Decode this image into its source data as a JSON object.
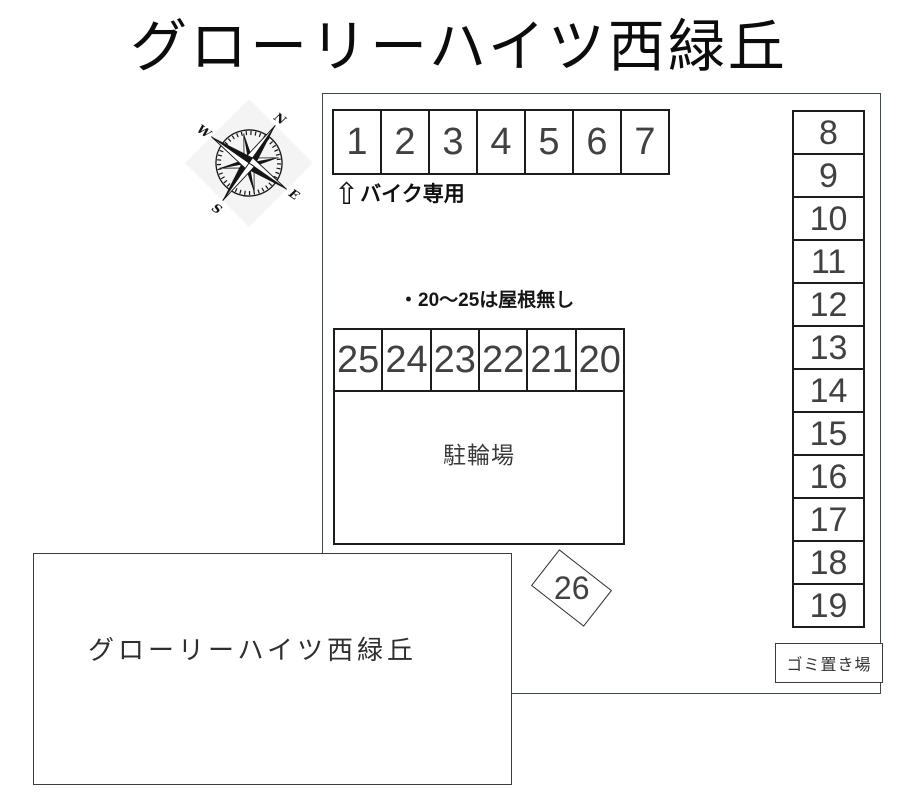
{
  "page": {
    "title": "グローリーハイツ西緑丘"
  },
  "compass": {
    "north_label": "N",
    "east_label": "E",
    "south_label": "S",
    "west_label": "W",
    "rotation_deg": 35
  },
  "bike_row": {
    "spaces": [
      "1",
      "2",
      "3",
      "4",
      "5",
      "6",
      "7"
    ],
    "arrow": "⇧",
    "caption": "バイク専用"
  },
  "note": {
    "text": "・20〜25は屋根無し"
  },
  "uncovered_row": {
    "spaces": [
      "25",
      "24",
      "23",
      "22",
      "21",
      "20"
    ]
  },
  "right_column": {
    "spaces": [
      "8",
      "9",
      "10",
      "11",
      "12",
      "13",
      "14",
      "15",
      "16",
      "17",
      "18",
      "19"
    ]
  },
  "bicycle_area": {
    "label": "駐輪場"
  },
  "diagonal_space": {
    "label": "26"
  },
  "garbage_area": {
    "label": "ゴミ置き場"
  },
  "building": {
    "label": "グローリーハイツ西緑丘"
  },
  "colors": {
    "line": "#1c1c1c",
    "boundary": "#3f4654",
    "text": "#414141",
    "background": "#ffffff"
  }
}
